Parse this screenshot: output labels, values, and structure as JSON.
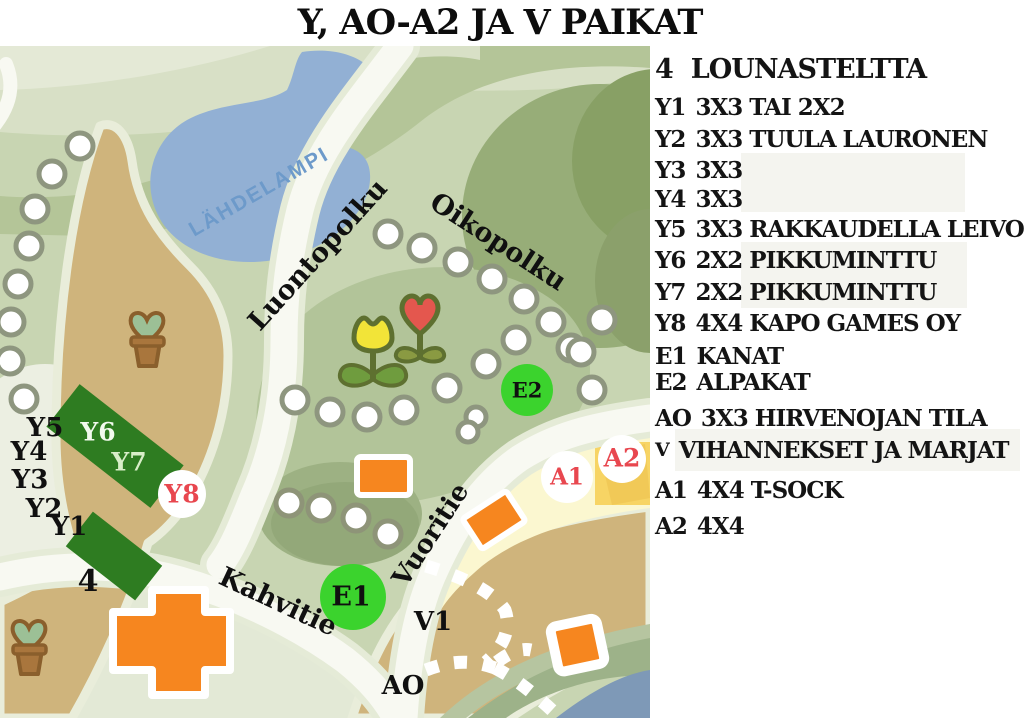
{
  "title": "Y, AO-A2 JA V PAIKAT",
  "legend": {
    "items": [
      {
        "code": "4",
        "desc": "LOUNASTELTTA"
      },
      {
        "code": "Y1",
        "desc": "3X3 TAI 2X2"
      },
      {
        "code": "Y2",
        "desc": "3X3 TUULA LAURONEN"
      },
      {
        "code": "Y3",
        "desc": "3X3"
      },
      {
        "code": "Y4",
        "desc": "3X3"
      },
      {
        "code": "Y5",
        "desc": "3X3 RAKKAUDELLA LEIVON"
      },
      {
        "code": "Y6",
        "desc": "2X2 PIKKUMINTTU"
      },
      {
        "code": "Y7",
        "desc": "2X2 PIKKUMINTTU"
      },
      {
        "code": "Y8",
        "desc": "4X4 KAPO GAMES OY"
      },
      {
        "code": "E1",
        "desc": "KANAT"
      },
      {
        "code": "E2",
        "desc": "ALPAKAT"
      },
      {
        "code": "AO",
        "desc": "3X3 HIRVENOJAN TILA"
      },
      {
        "code": "V",
        "desc": "VIHANNEKSET JA MARJAT"
      },
      {
        "code": "A1",
        "desc": "4X4 T-SOCK"
      },
      {
        "code": "A2",
        "desc": "4X4"
      }
    ]
  },
  "map": {
    "pond_label": "LÄHDELAMPI",
    "road_labels": {
      "luontopolku": "Luontopolku",
      "oikopolku": "Oikopolku",
      "vuoritie": "Vuoritie",
      "kahvitie": "Kahvitie"
    },
    "spot_labels": {
      "y1": "Y1",
      "y2": "Y2",
      "y3": "Y3",
      "y4": "Y4",
      "y5": "Y5",
      "y6": "Y6",
      "y7": "Y7",
      "four": "4",
      "v1": "V1",
      "ao": "AO"
    },
    "markers": {
      "e1": "E1",
      "e2": "E2",
      "y8": "Y8",
      "a1": "A1",
      "a2": "A2"
    }
  },
  "colors": {
    "marker_green": "#3bd32d",
    "plot_dark_green": "#2e7c21",
    "building_orange": "#f6861f",
    "label_red": "#e8474f",
    "pond_blue": "#92b0d4",
    "path_tan": "#cfb47c",
    "amber_square": "#f7d464",
    "map_base_green": "#c8d5b2"
  }
}
